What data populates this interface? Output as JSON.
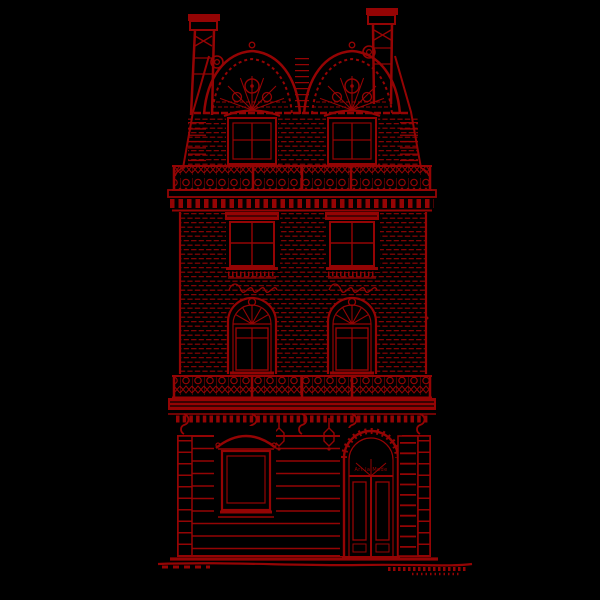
{
  "illustration": {
    "subject": "Art Nouveau building facade, red ink sketch on black",
    "door_sign": "Art la Mode"
  },
  "colors": {
    "background": "#000000",
    "ink": "#940404",
    "glass": "#000000"
  }
}
